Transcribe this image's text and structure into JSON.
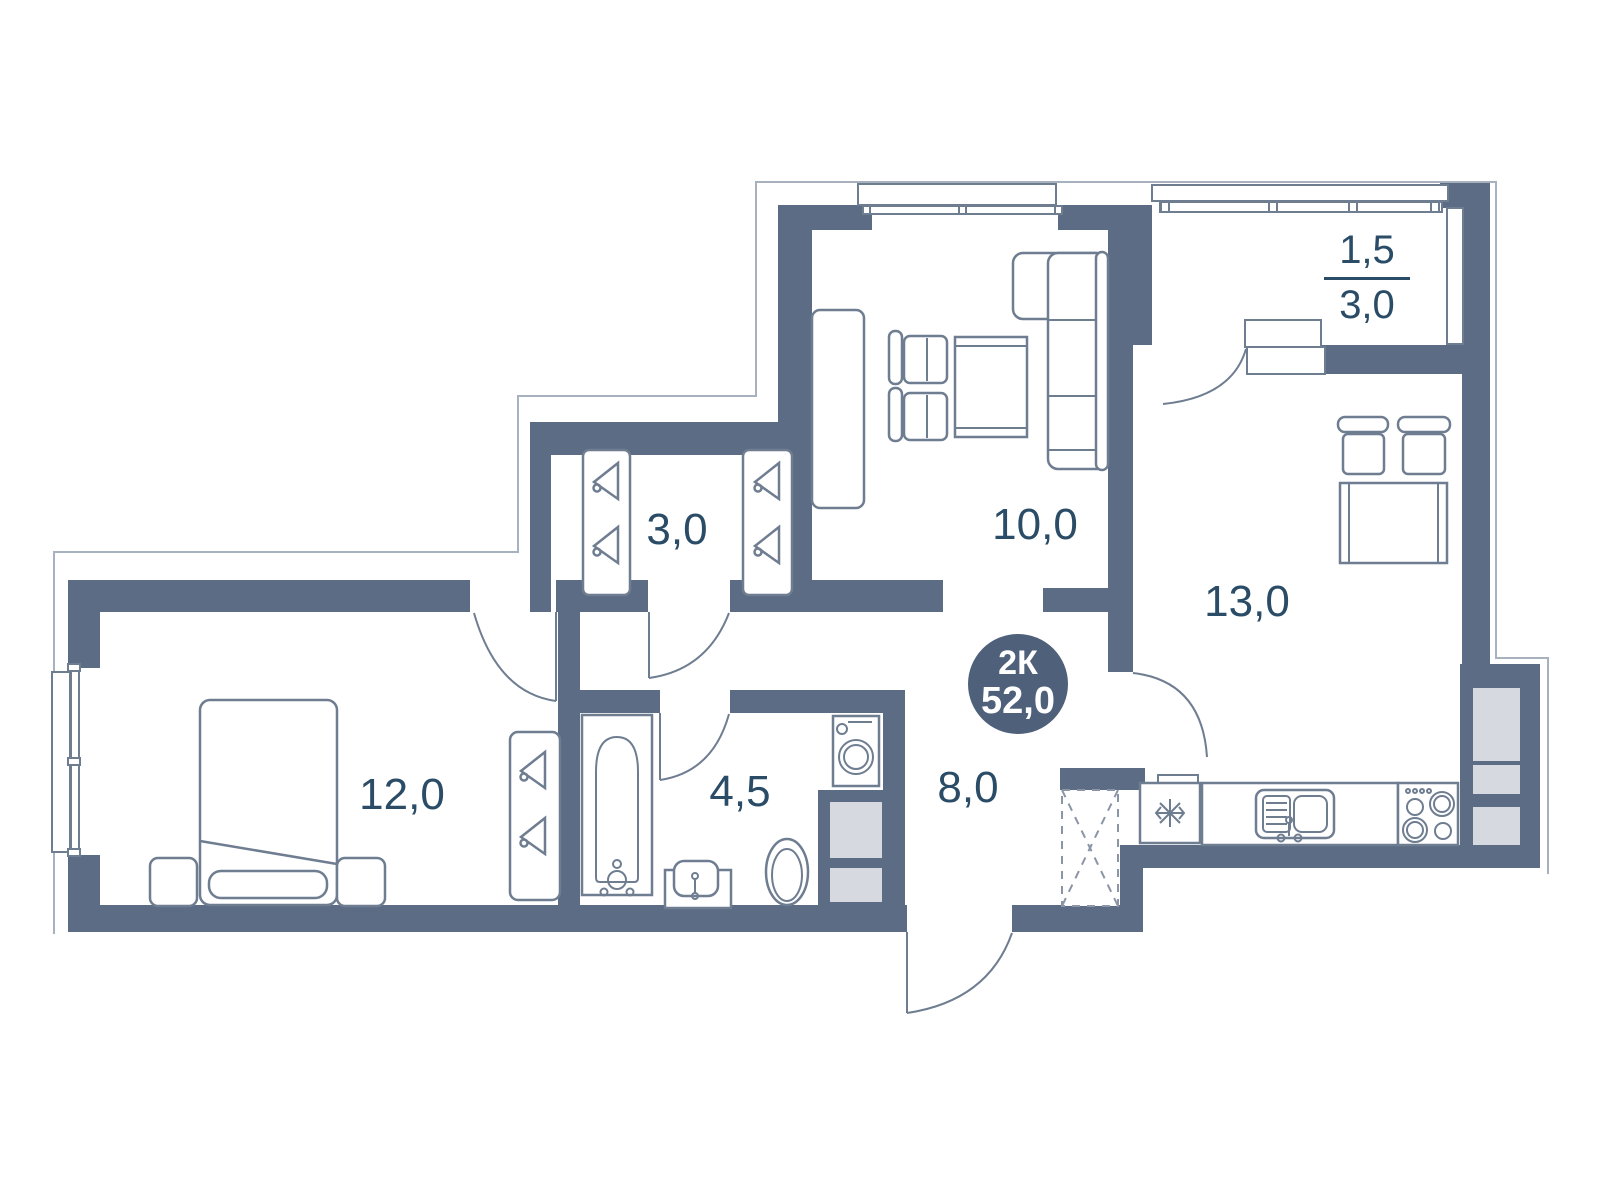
{
  "floor_plan": {
    "badge": {
      "rooms": "2К",
      "total_area": "52,0"
    },
    "rooms": {
      "living": {
        "label": "10,0"
      },
      "kitchen_living": {
        "label": "13,0"
      },
      "bedroom": {
        "label": "12,0"
      },
      "hallway": {
        "label": "8,0"
      },
      "bathroom": {
        "label": "4,5"
      },
      "wardrobe": {
        "label": "3,0"
      },
      "balcony": {
        "numerator": "1,5",
        "denominator": "3,0"
      }
    },
    "colors": {
      "wall": "#5c6c85",
      "furniture_line": "#6f7d91",
      "outline": "#a8b1be",
      "light_fill": "#d6d9e0",
      "dashed_line": "#8a95a5",
      "label_text": "#2a4c66",
      "badge_fill": "#4f607a"
    }
  }
}
